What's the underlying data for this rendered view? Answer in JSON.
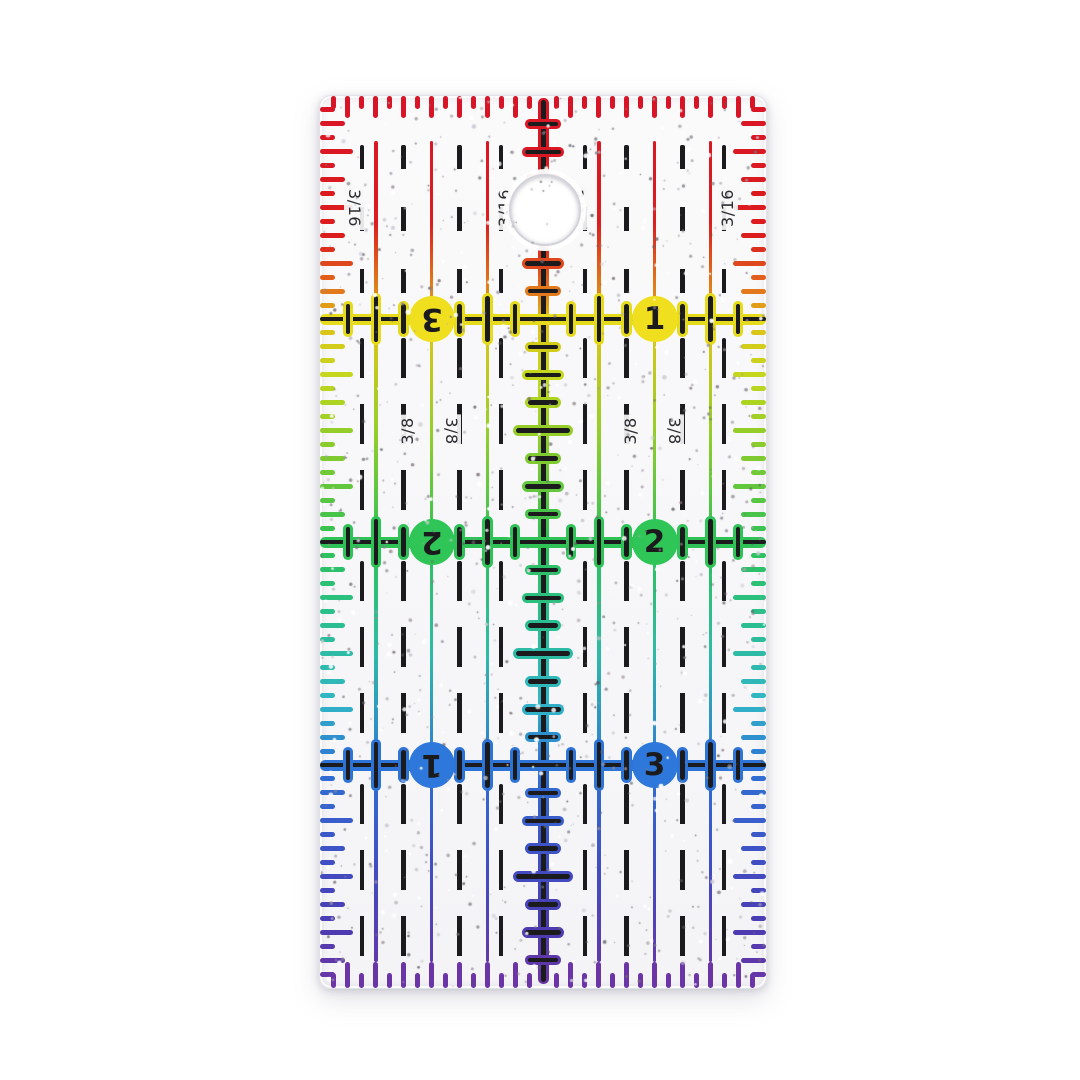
{
  "product": {
    "description": "Transparent glitter acrylic quilting seam ruler, 2 inch by 4 inch, rainbow gradient markings, hanging hole at top center, photographed on white background"
  },
  "ruler_geometry": {
    "left_px": 319,
    "top_px": 95,
    "inch_px": 223,
    "width_inches": 2,
    "height_inches": 4,
    "corner_radius_px": 12,
    "hole": {
      "x_in": 1.0,
      "y_in": 0.5,
      "radius_px": 34
    }
  },
  "scale_marks": {
    "edge_tick_spacing_in": 0.0625,
    "grid_tick_spacing_in": 0.125,
    "solid_line_offsets_in": [
      0.25,
      0.5,
      0.75
    ],
    "dashed_line_offsets_in": [
      0.1875,
      0.375,
      0.625,
      0.8125
    ],
    "inch_lines_in": [
      1,
      2,
      3
    ]
  },
  "printed_text": {
    "fraction_labels": [
      {
        "text": "3/16",
        "section": 0,
        "attach_offsets_in": [
          0.1875,
          0.8125
        ],
        "label_y_in": 0.5
      },
      {
        "text": "3/8",
        "section": 1,
        "attach_offsets_in": [
          0.375,
          0.625
        ],
        "label_y_in": 1.5
      }
    ],
    "number_circles": [
      {
        "line_in": 1,
        "left_text": "3",
        "left_rotated": true,
        "right_text": "1",
        "right_rotated": false
      },
      {
        "line_in": 2,
        "left_text": "2",
        "left_rotated": true,
        "right_text": "2",
        "right_rotated": false
      },
      {
        "line_in": 3,
        "left_text": "1",
        "left_rotated": true,
        "right_text": "3",
        "right_rotated": false
      }
    ]
  },
  "colors": {
    "page_background": "#ffffff",
    "ruler_body": "#f7f7f9",
    "ink_black": "#1b1b1e",
    "label_ink": "#2b2b30",
    "gradient_stops": [
      [
        0.0,
        "#d81527"
      ],
      [
        0.16,
        "#dc1d1d"
      ],
      [
        0.215,
        "#e2711b"
      ],
      [
        0.25,
        "#e0c016"
      ],
      [
        0.31,
        "#c6d71d"
      ],
      [
        0.4,
        "#84cb2e"
      ],
      [
        0.5,
        "#2dc156"
      ],
      [
        0.585,
        "#2bbf8e"
      ],
      [
        0.68,
        "#31b6c6"
      ],
      [
        0.75,
        "#2e72d4"
      ],
      [
        0.85,
        "#3f51c5"
      ],
      [
        0.93,
        "#4b3cb2"
      ],
      [
        1.0,
        "#6d35a6"
      ]
    ],
    "inch_line_halos": [
      "#e6da1d",
      "#2ec257",
      "#2e74d6"
    ],
    "circle_fills": [
      "#f0df1e",
      "#2fc657",
      "#2d78da"
    ]
  },
  "texture": {
    "glitter": true,
    "dark_speckles": 820,
    "white_sparkles": 240,
    "silver_flecks": 70
  }
}
